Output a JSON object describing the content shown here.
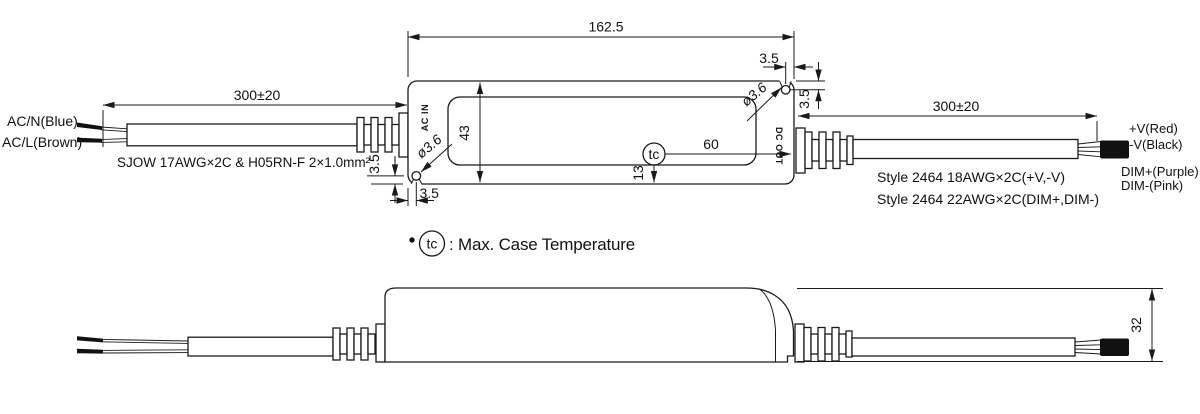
{
  "colors": {
    "line": "#1a1a1a",
    "background": "#ffffff"
  },
  "top_view": {
    "dims": {
      "length": "162.5",
      "height": "43",
      "cable_left": "300±20",
      "cable_right": "300±20",
      "hole_edge_h_right": "3.5",
      "hole_edge_v_right": "3.5",
      "hole_edge_v_left": "3.5",
      "hole_edge_h_left": "3.5",
      "hole_dia_right": "ø3.6",
      "hole_dia_left": "ø3.6",
      "tc_to_edge": "60",
      "tc_to_bottom": "13"
    },
    "case": {
      "ac_in": "AC IN",
      "dc_out": "DC OUT",
      "tc_symbol": "tc"
    },
    "input": {
      "wire1": "AC/N(Blue)",
      "wire2": "AC/L(Brown)",
      "spec": "SJOW 17AWG×2C & H05RN-F 2×1.0mm²"
    },
    "output": {
      "wire1": "+V(Red)",
      "wire2": "-V(Black)",
      "wire3": "DIM+(Purple)",
      "wire4": "DIM-(Pink)",
      "spec1": "Style 2464 18AWG×2C(+V,-V)",
      "spec2": "Style 2464 22AWG×2C(DIM+,DIM-)"
    }
  },
  "note": {
    "symbol": "tc",
    "text": ": Max. Case Temperature"
  },
  "side_view": {
    "dims": {
      "height": "32"
    }
  }
}
